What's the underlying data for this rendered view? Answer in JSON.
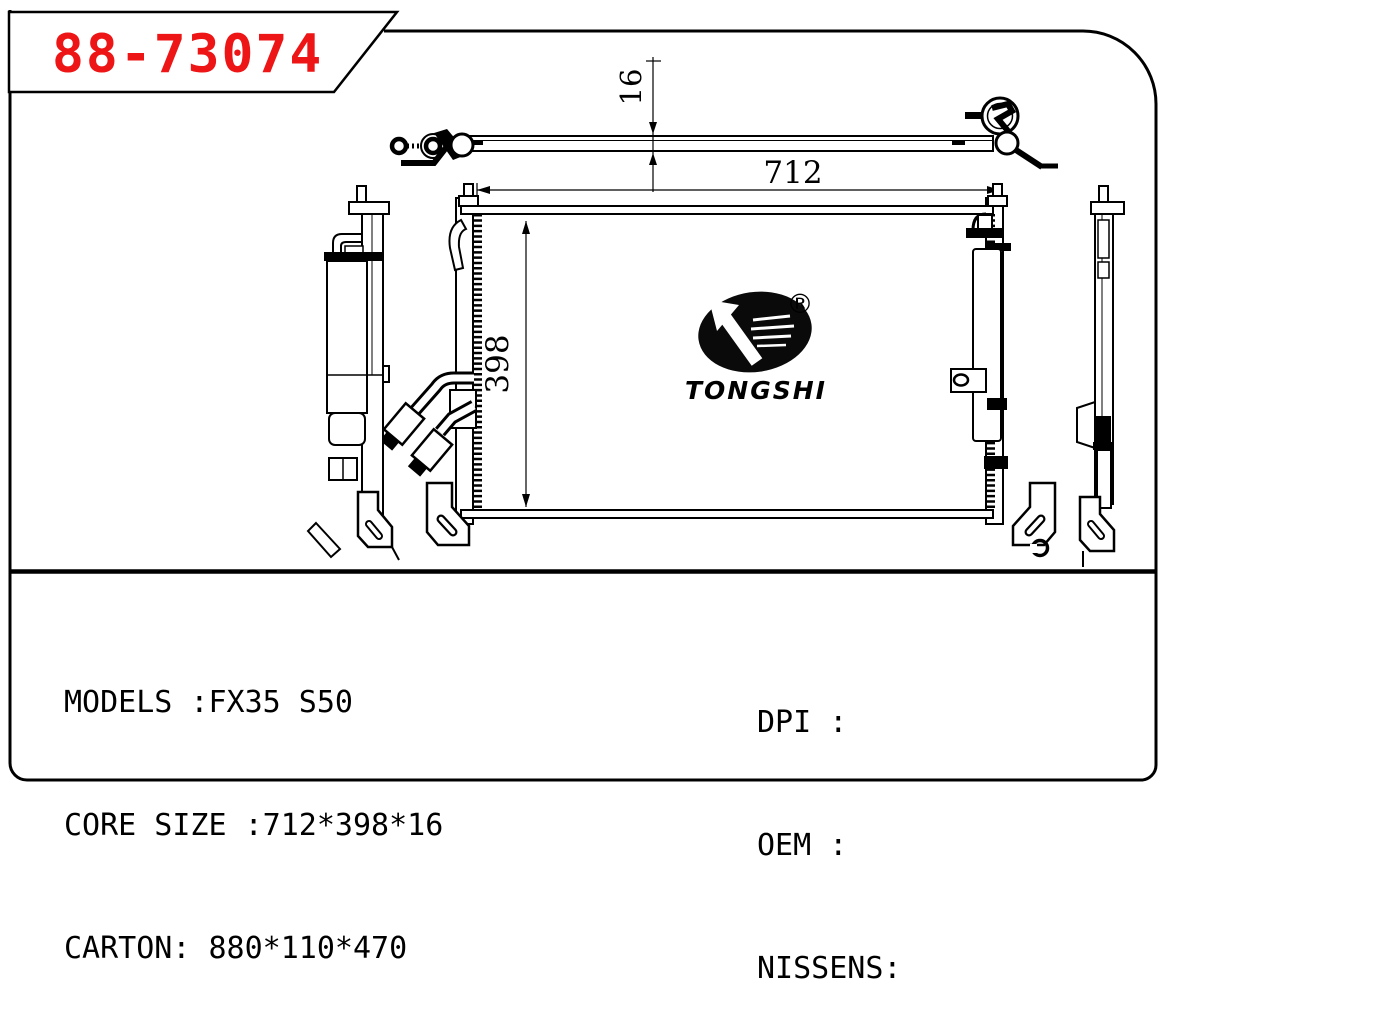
{
  "part_number": "88-73074",
  "logo": {
    "brand": "TONGSHI",
    "registered_mark": "®"
  },
  "dimensions": {
    "core_width": "712",
    "core_height": "398",
    "core_depth": "16"
  },
  "title_block": {
    "left_lines": [
      "MODELS :FX35 S50",
      "CORE SIZE :712*398*16",
      "CARTON: 880*110*470"
    ],
    "right_lines": [
      "DPI :",
      "OEM :",
      "NISSENS:"
    ]
  },
  "colors": {
    "part_number_red": "#ed1515",
    "line_black": "#000000"
  }
}
